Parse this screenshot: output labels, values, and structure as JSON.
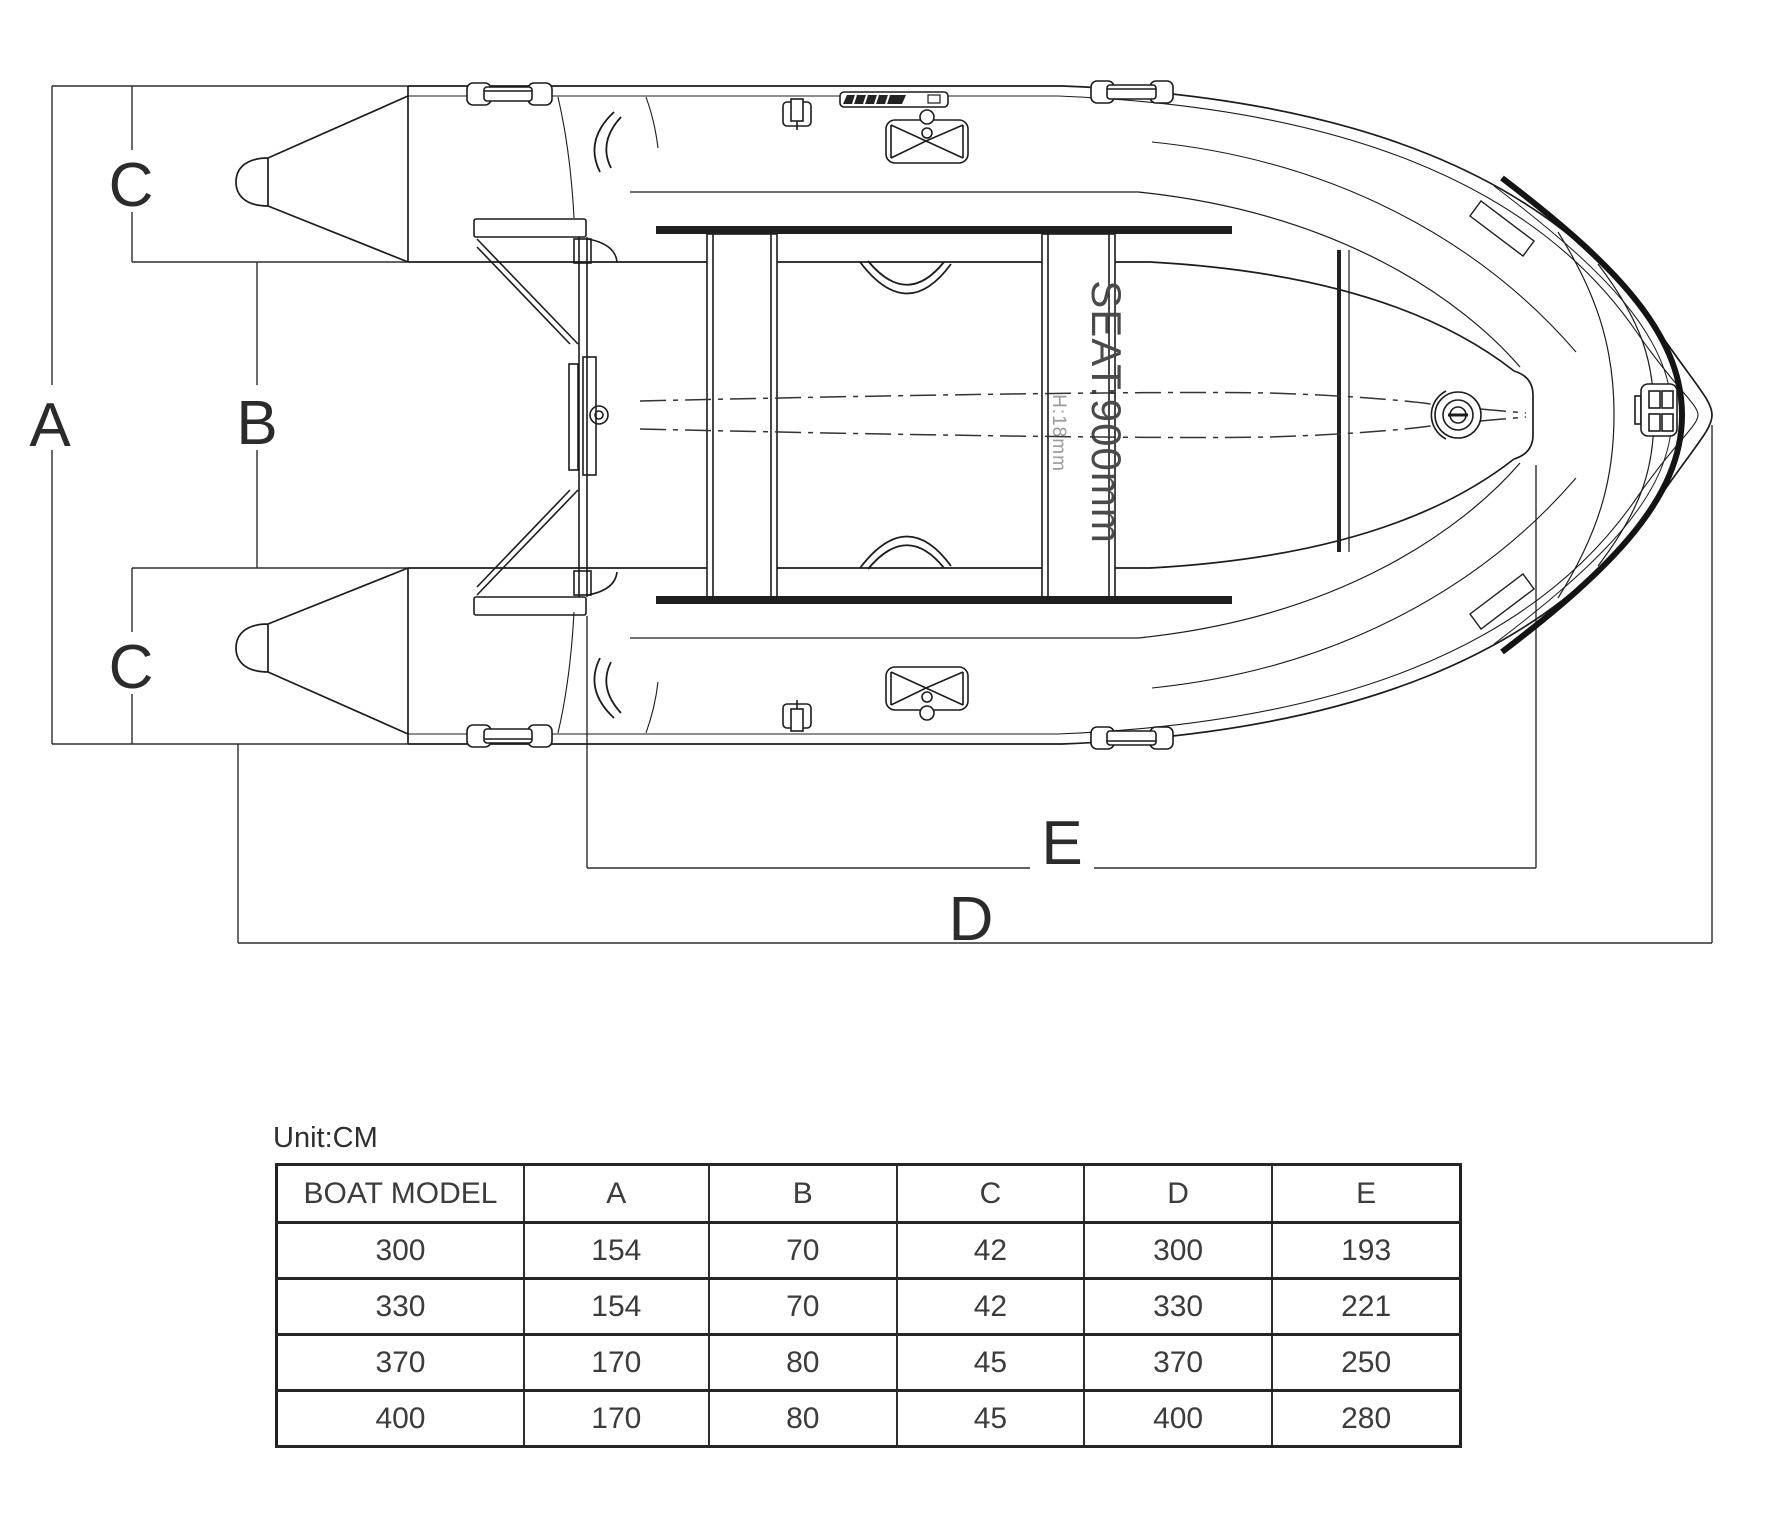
{
  "diagram": {
    "dimension_labels": {
      "a": "A",
      "b": "B",
      "c_top": "C",
      "c_bottom": "C",
      "d": "D",
      "e": "E"
    },
    "annotations": {
      "seat": "SEAT:900mm",
      "seat_height": "H:18mm"
    },
    "colors": {
      "line": "#1c1c1c",
      "dim": "#2e2e2e",
      "muted": "#9a9a9a",
      "background": "#ffffff"
    }
  },
  "table": {
    "unit_label": "Unit:CM",
    "headers": [
      "BOAT MODEL",
      "A",
      "B",
      "C",
      "D",
      "E"
    ],
    "rows": [
      [
        "300",
        "154",
        "70",
        "42",
        "300",
        "193"
      ],
      [
        "330",
        "154",
        "70",
        "42",
        "330",
        "221"
      ],
      [
        "370",
        "170",
        "80",
        "45",
        "370",
        "250"
      ],
      [
        "400",
        "170",
        "80",
        "45",
        "400",
        "280"
      ]
    ]
  }
}
